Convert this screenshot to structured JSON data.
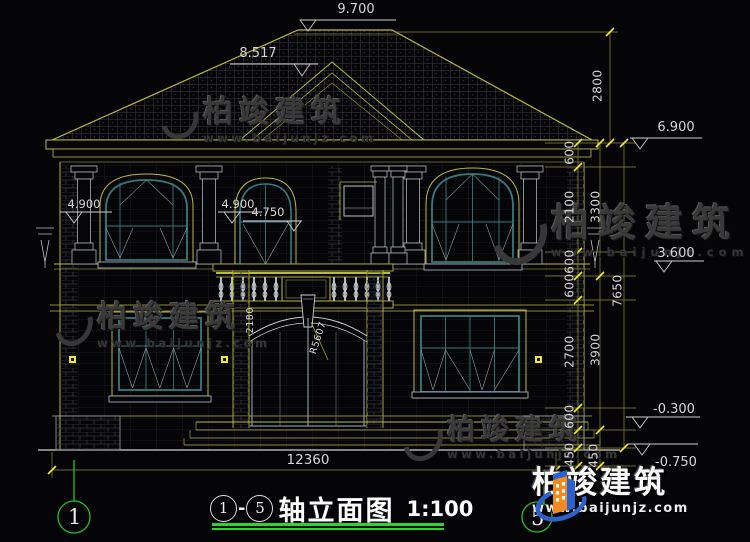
{
  "title": {
    "axis_start": "1",
    "dash": "-",
    "axis_end": "5",
    "name": "轴立面图",
    "scale": "1:100"
  },
  "axis_bubbles": {
    "left": "1",
    "right": "5"
  },
  "elevations": {
    "ridge": "9.700",
    "gable": "8.517",
    "eave": "6.900",
    "left_pilaster": "4.900",
    "balcony": "4.900",
    "balcony_rail": "4.750",
    "second_floor": "3.600",
    "ground": "-0.300",
    "footing": "-0.750"
  },
  "dims": {
    "roof_height": "2800",
    "right_inner": [
      "600",
      "2100",
      "600",
      "600",
      "2700",
      "600",
      "450"
    ],
    "right_middle": [
      "3300",
      "3900",
      "450"
    ],
    "right_total": "7650",
    "bottom_total": "12360"
  },
  "door": {
    "width_label": "2180",
    "radius_label": "R5607"
  },
  "watermark": {
    "text": "柏竣建筑",
    "url": "www.baijunjz.com"
  },
  "logo": {
    "name": "柏竣建筑",
    "url": "www.baijunjz.com"
  }
}
